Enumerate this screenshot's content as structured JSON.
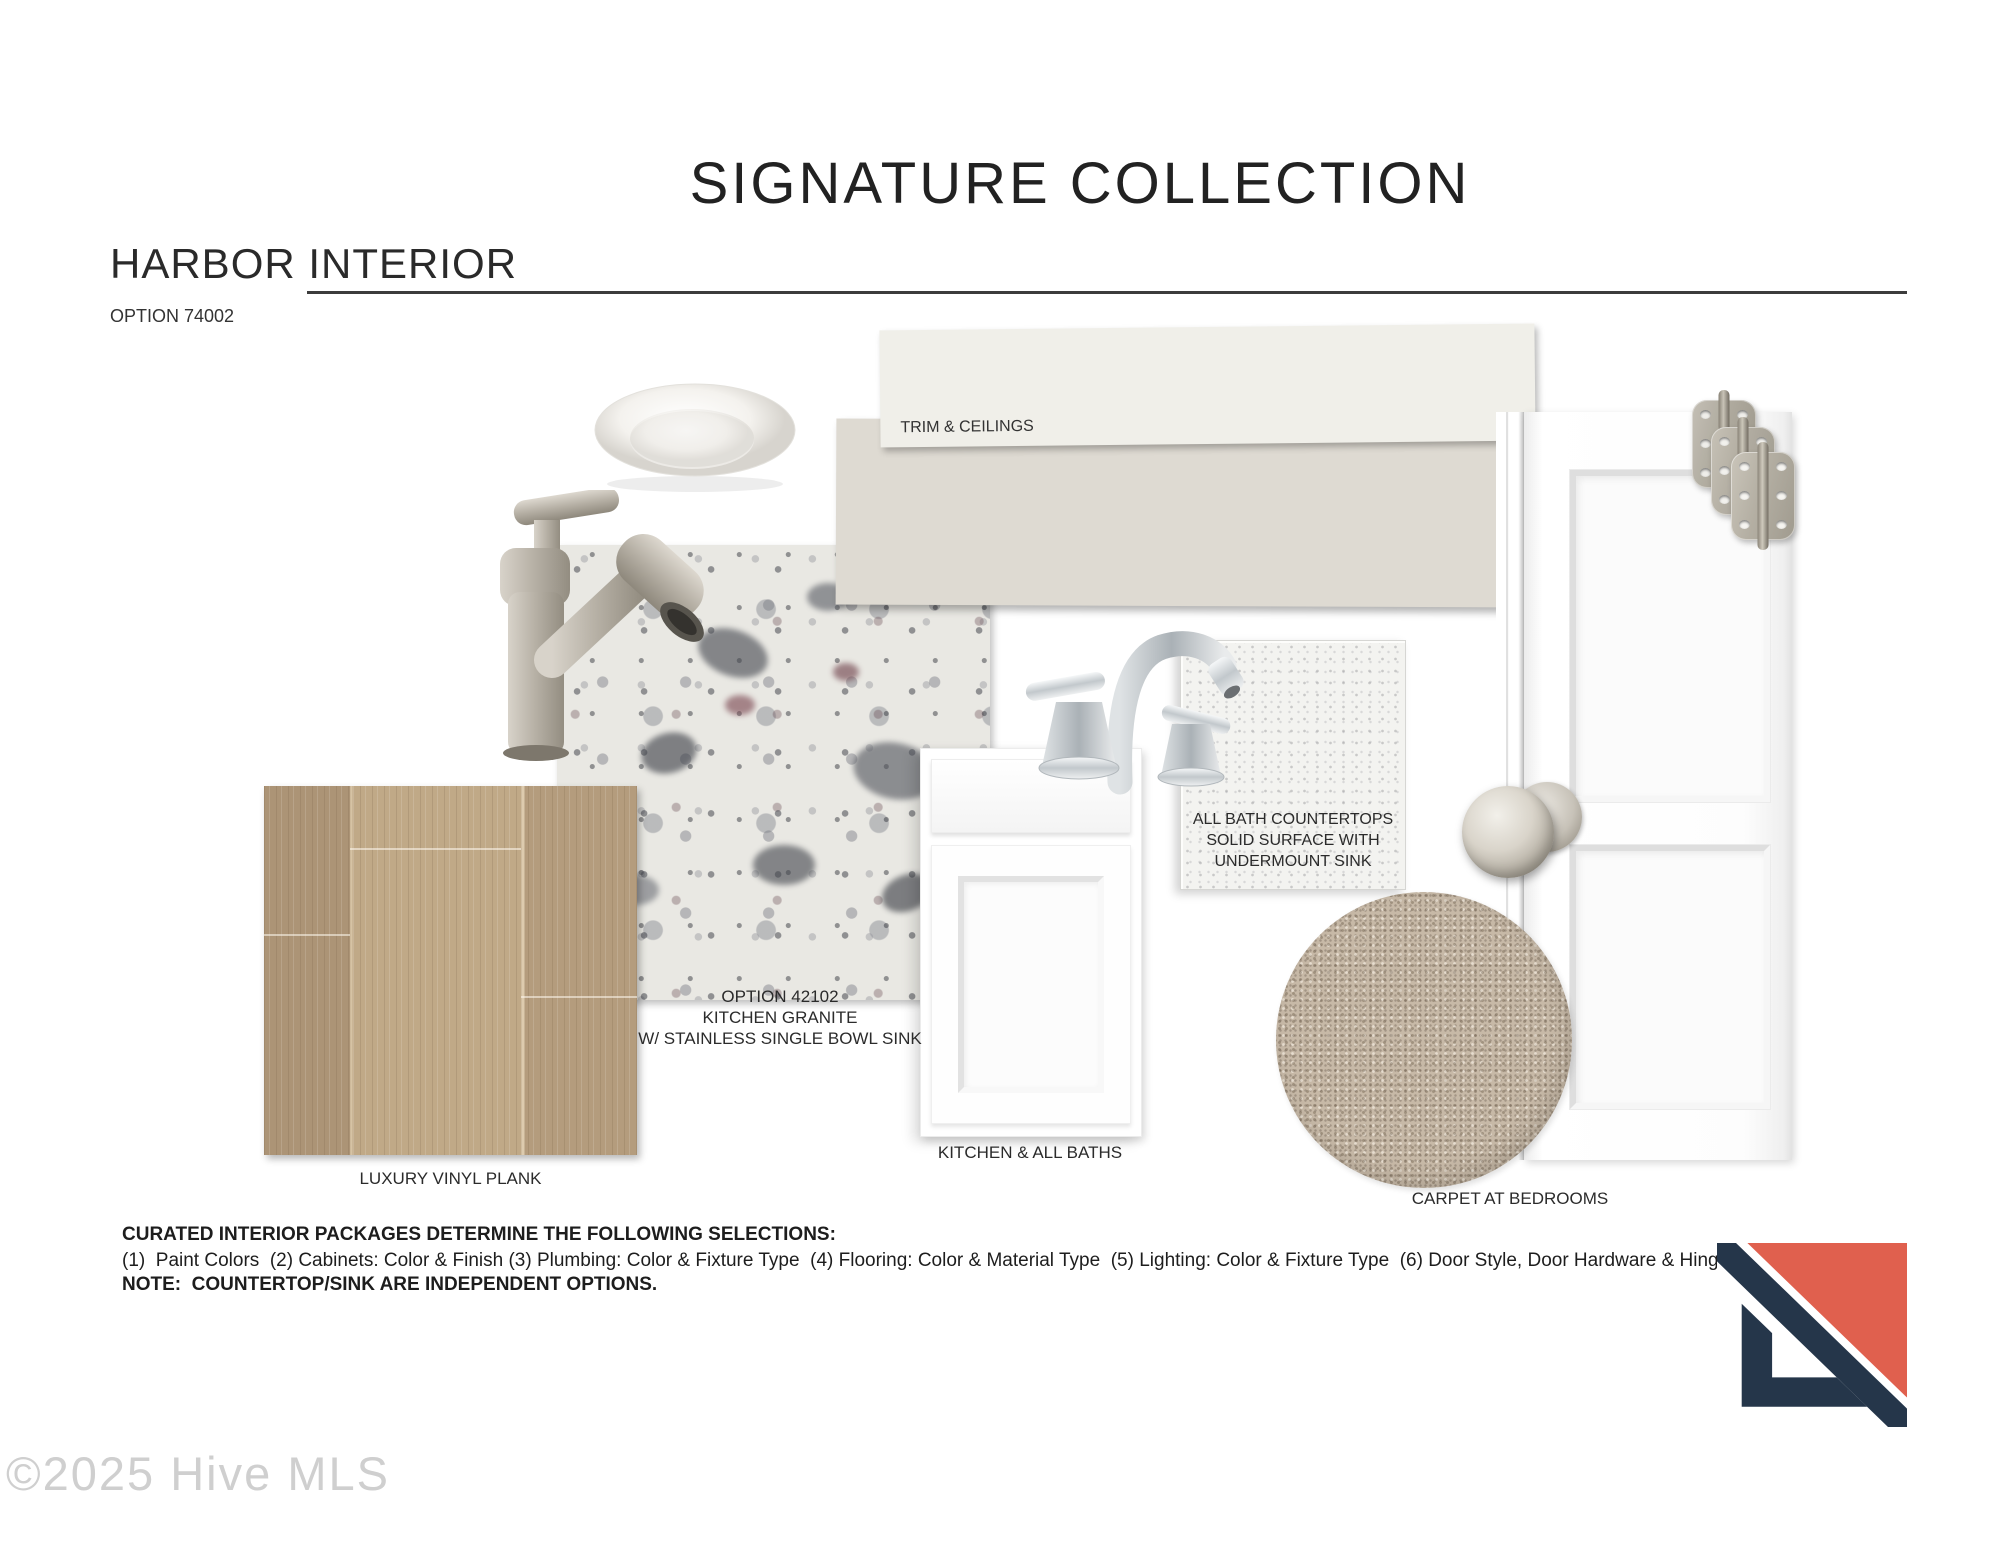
{
  "header": {
    "title": "SIGNATURE COLLECTION",
    "collection": "HARBOR INTERIOR",
    "option": "OPTION 74002"
  },
  "paint": {
    "trim_label": "TRIM & CEILINGS",
    "trim_color": "#F0EFE9",
    "wall_color": "#DEDAD2"
  },
  "granite_caption": {
    "line1": "OPTION 42102",
    "line2": "KITCHEN GRANITE",
    "line3": "W/ STAINLESS SINGLE BOWL SINK"
  },
  "bath_countertop": {
    "line1": "ALL BATH COUNTERTOPS",
    "line2": "SOLID SURFACE WITH",
    "line3": "UNDERMOUNT SINK"
  },
  "labels": {
    "flooring": "LUXURY VINYL PLANK",
    "cabinet": "KITCHEN & ALL BATHS",
    "carpet": "CARPET AT BEDROOMS"
  },
  "footer": {
    "heading": "CURATED INTERIOR PACKAGES DETERMINE THE FOLLOWING SELECTIONS:",
    "selections": "(1)  Paint Colors  (2) Cabinets: Color & Finish (3) Plumbing: Color & Fixture Type  (4) Flooring: Color & Material Type  (5) Lighting: Color & Fixture Type  (6) Door Style, Door Hardware & Hinges",
    "note": "NOTE:  COUNTERTOP/SINK ARE INDEPENDENT OPTIONS."
  },
  "watermark": "©2025 Hive MLS",
  "brand": {
    "logo_coral": "#E0604E",
    "logo_navy": "#25364A",
    "logo_white": "#FFFFFF"
  }
}
